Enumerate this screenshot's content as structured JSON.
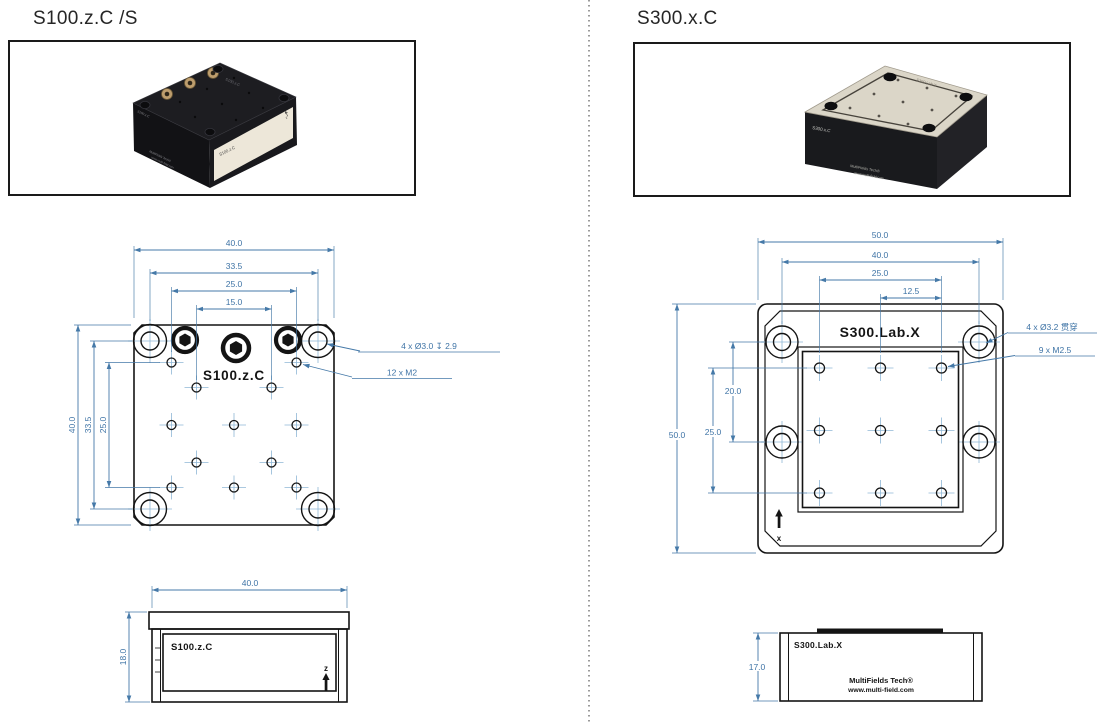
{
  "s100": {
    "title": "S100.z.C /S",
    "top_view": {
      "label": "S100.z.C",
      "dims_top": [
        "40.0",
        "33.5",
        "25.0",
        "15.0"
      ],
      "dims_side": [
        "40.0",
        "33.5",
        "25.0"
      ],
      "note_holes": "4 x Ø3.0 ↧ 2.9",
      "note_thread": "12 x  M2"
    },
    "side_view": {
      "label": "S100.z.C",
      "dim_width": "40.0",
      "dim_height": "18.0",
      "axis": "z"
    },
    "photo": {
      "top_mark": "S100.z.C",
      "side_mark": "S100.z.C",
      "front_label": "S100.z.C",
      "front_axis": "z",
      "brand_line1": "MultiFields Tech®",
      "brand_line2": "www.multi-field.com"
    }
  },
  "s300": {
    "title": "S300.x.C",
    "top_view": {
      "label": "S300.Lab.X",
      "dims_top": [
        "50.0",
        "40.0",
        "25.0",
        "12.5"
      ],
      "dims_side": [
        "50.0",
        "25.0",
        "20.0"
      ],
      "note_holes": "4 x  Ø3.2 贯穿",
      "note_thread": "9 x  M2.5",
      "axis": "x"
    },
    "side_view": {
      "label": "S300.Lab.X",
      "dim_height": "17.0",
      "brand_line1": "MultiFields Tech®",
      "brand_line2": "www.multi-field.com"
    },
    "photo": {
      "top_mark": "S300.Lab.X",
      "side_mark": "S300.x.C",
      "brand_line1": "MultiFields Tech®",
      "brand_line2": "www.multi-field.com"
    }
  },
  "colors": {
    "dimension_blue": "#4579a8",
    "centerline_blue": "#8fb7d6",
    "drawing_line": "#141414"
  }
}
